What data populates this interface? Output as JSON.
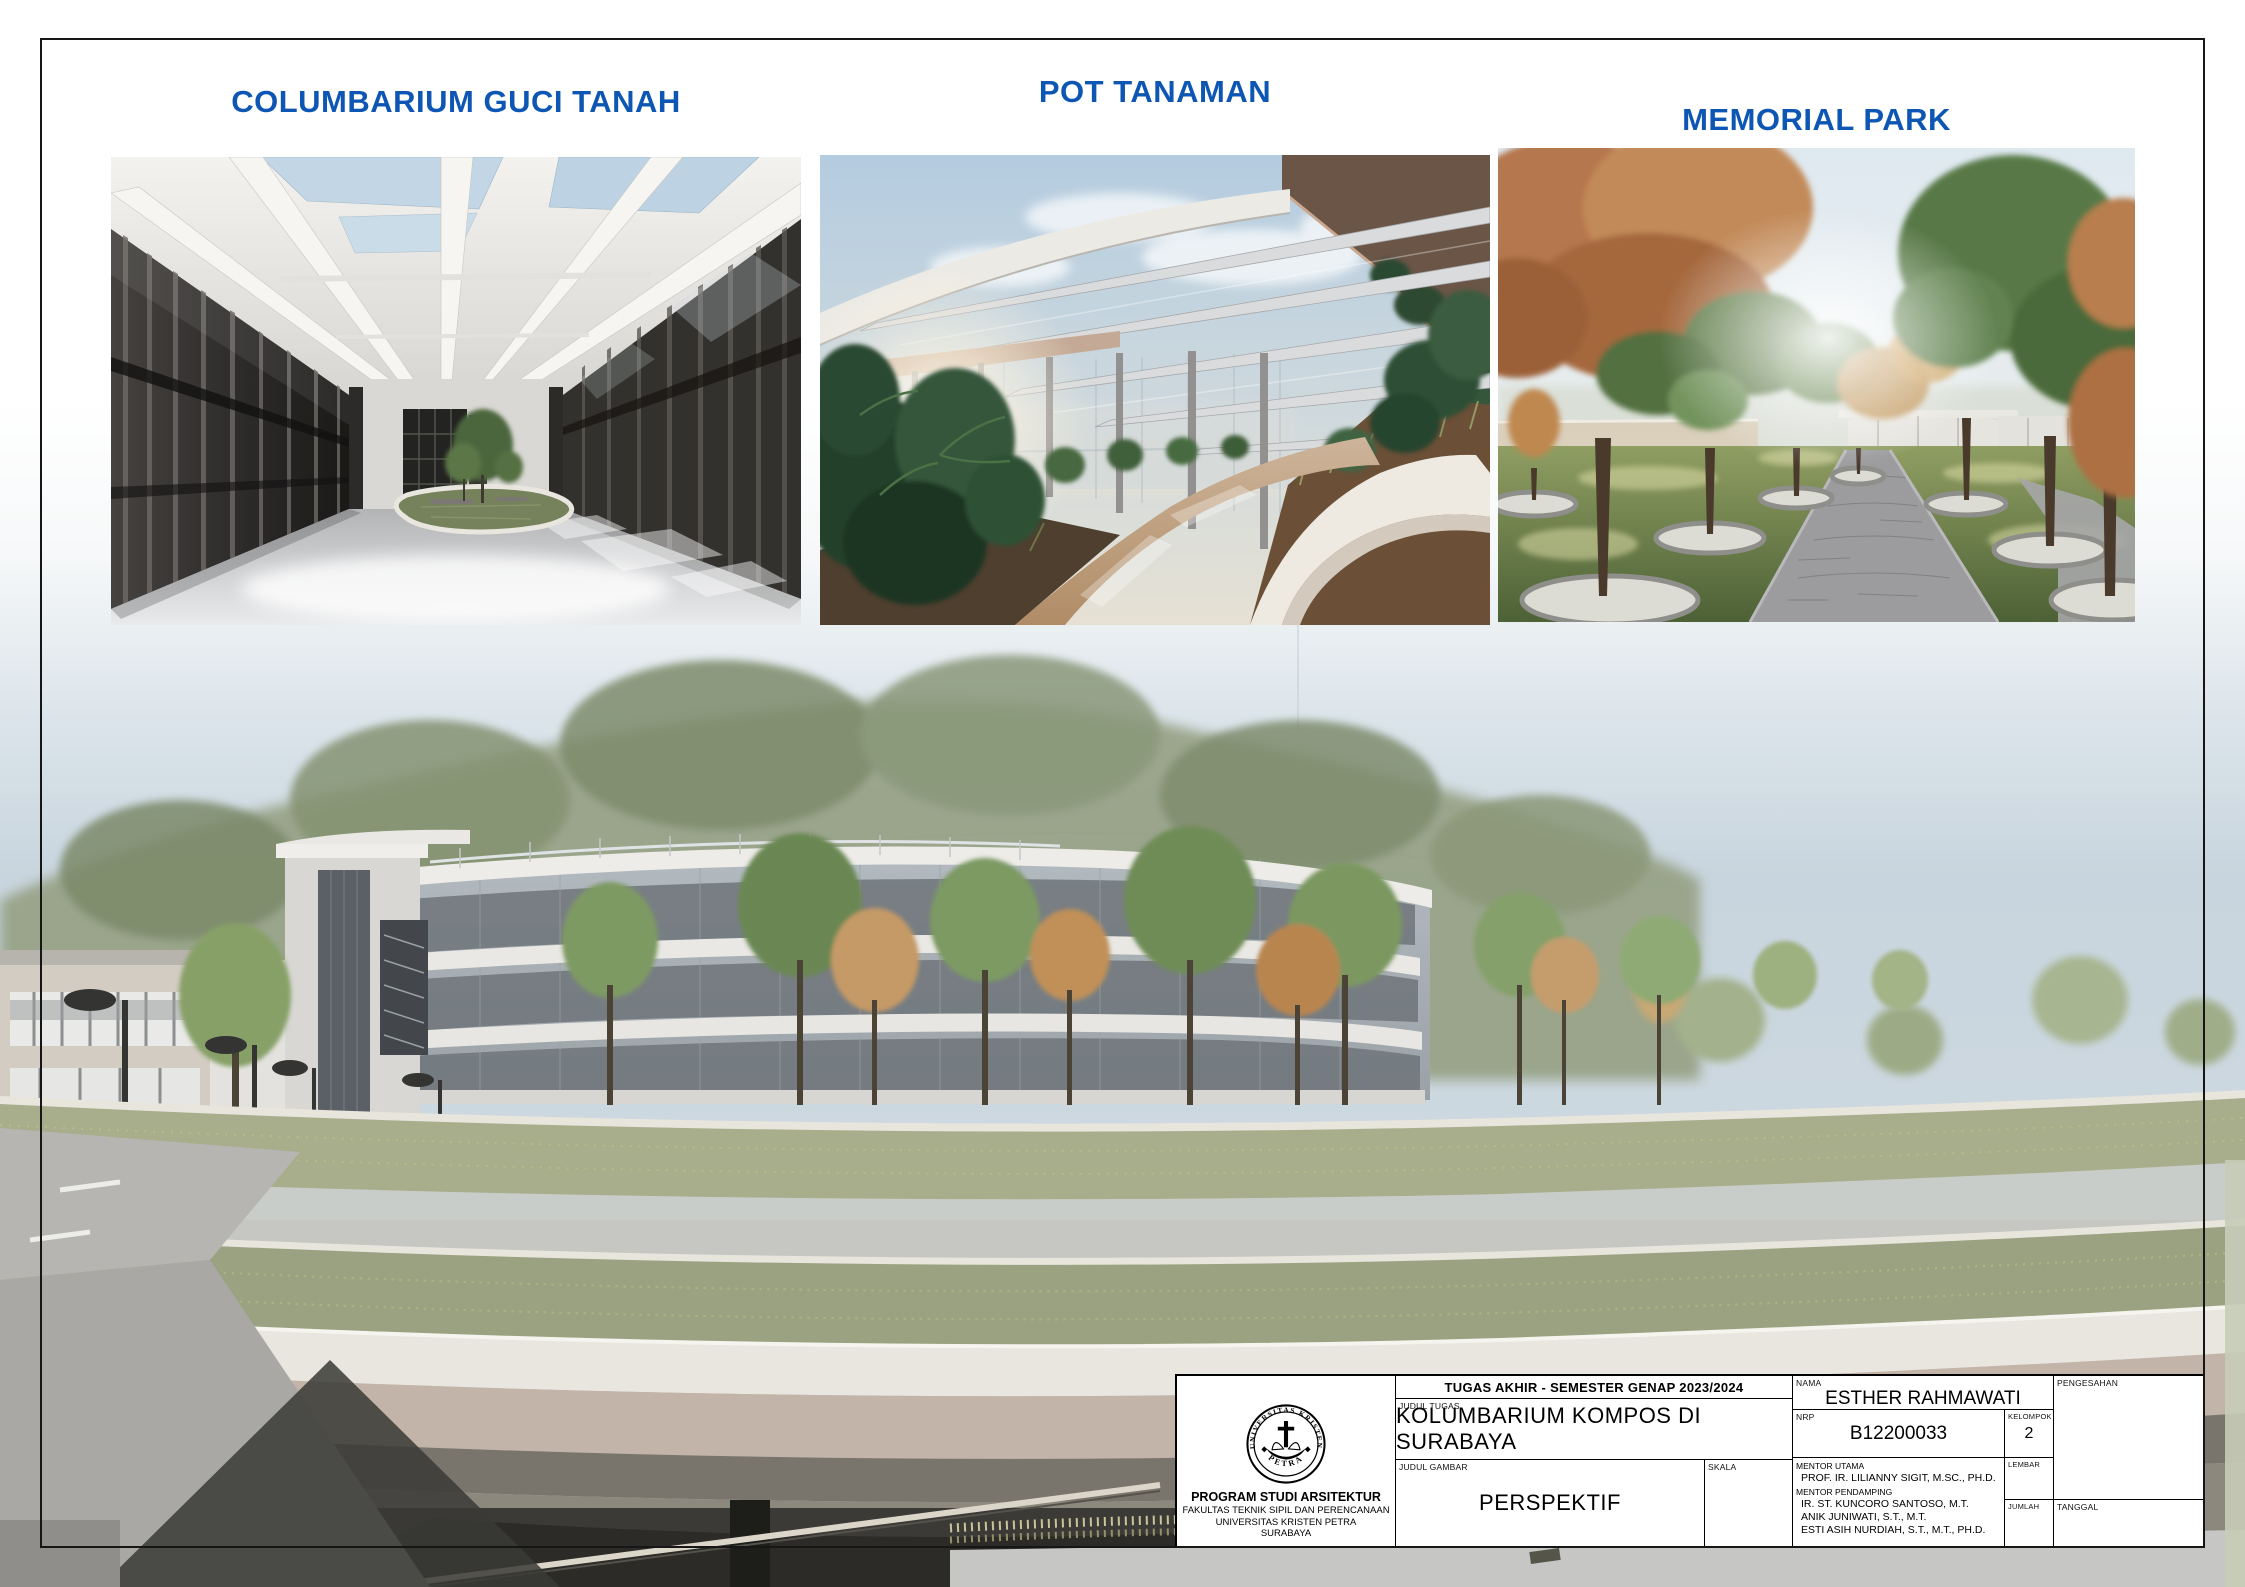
{
  "page": {
    "heading_color": "#0e56b4",
    "headings": [
      "COLUMBARIUM GUCI TANAH",
      "POT TANAMAN",
      "MEMORIAL PARK"
    ]
  },
  "title_block": {
    "header": "TUGAS AKHIR - SEMESTER GENAP  2023/2024",
    "fields": {
      "judul_tugas": {
        "label": "JUDUL TUGAS",
        "value": "KOLUMBARIUM KOMPOS DI SURABAYA"
      },
      "judul_gambar": {
        "label": "JUDUL GAMBAR",
        "value": "PERSPEKTIF"
      },
      "skala": {
        "label": "SKALA",
        "value": ""
      },
      "nama": {
        "label": "NAMA",
        "value": "ESTHER RAHMAWATI"
      },
      "nrp": {
        "label": "NRP",
        "value": "B12200033"
      },
      "kelompok": {
        "label": "KELOMPOK",
        "value": "2"
      },
      "mentor_utama": {
        "label": "MENTOR UTAMA",
        "value": "PROF. IR. LILIANNY SIGIT, M.SC., PH.D."
      },
      "mentor_pendamping": {
        "label": "MENTOR PENDAMPING",
        "values": [
          "IR. ST. KUNCORO SANTOSO, M.T.",
          "ANIK JUNIWATI, S.T., M.T.",
          "ESTI ASIH NURDIAH, S.T., M.T., PH.D."
        ]
      },
      "lembar": {
        "label": "LEMBAR",
        "value": ""
      },
      "jumlah": {
        "label": "JUMLAH",
        "value": ""
      },
      "pengesahan": {
        "label": "PENGESAHAN",
        "value": ""
      },
      "tanggal": {
        "label": "TANGGAL",
        "value": ""
      }
    },
    "institution": {
      "seal_top": "UNIVERSITAS KRISTEN",
      "seal_bottom": "PETRA",
      "program": "PROGRAM STUDI ARSITEKTUR",
      "faculty": "FAKULTAS TEKNIK SIPIL DAN PERENCANAAN",
      "university": "UNIVERSITAS KRISTEN PETRA",
      "city": "SURABAYA"
    }
  }
}
